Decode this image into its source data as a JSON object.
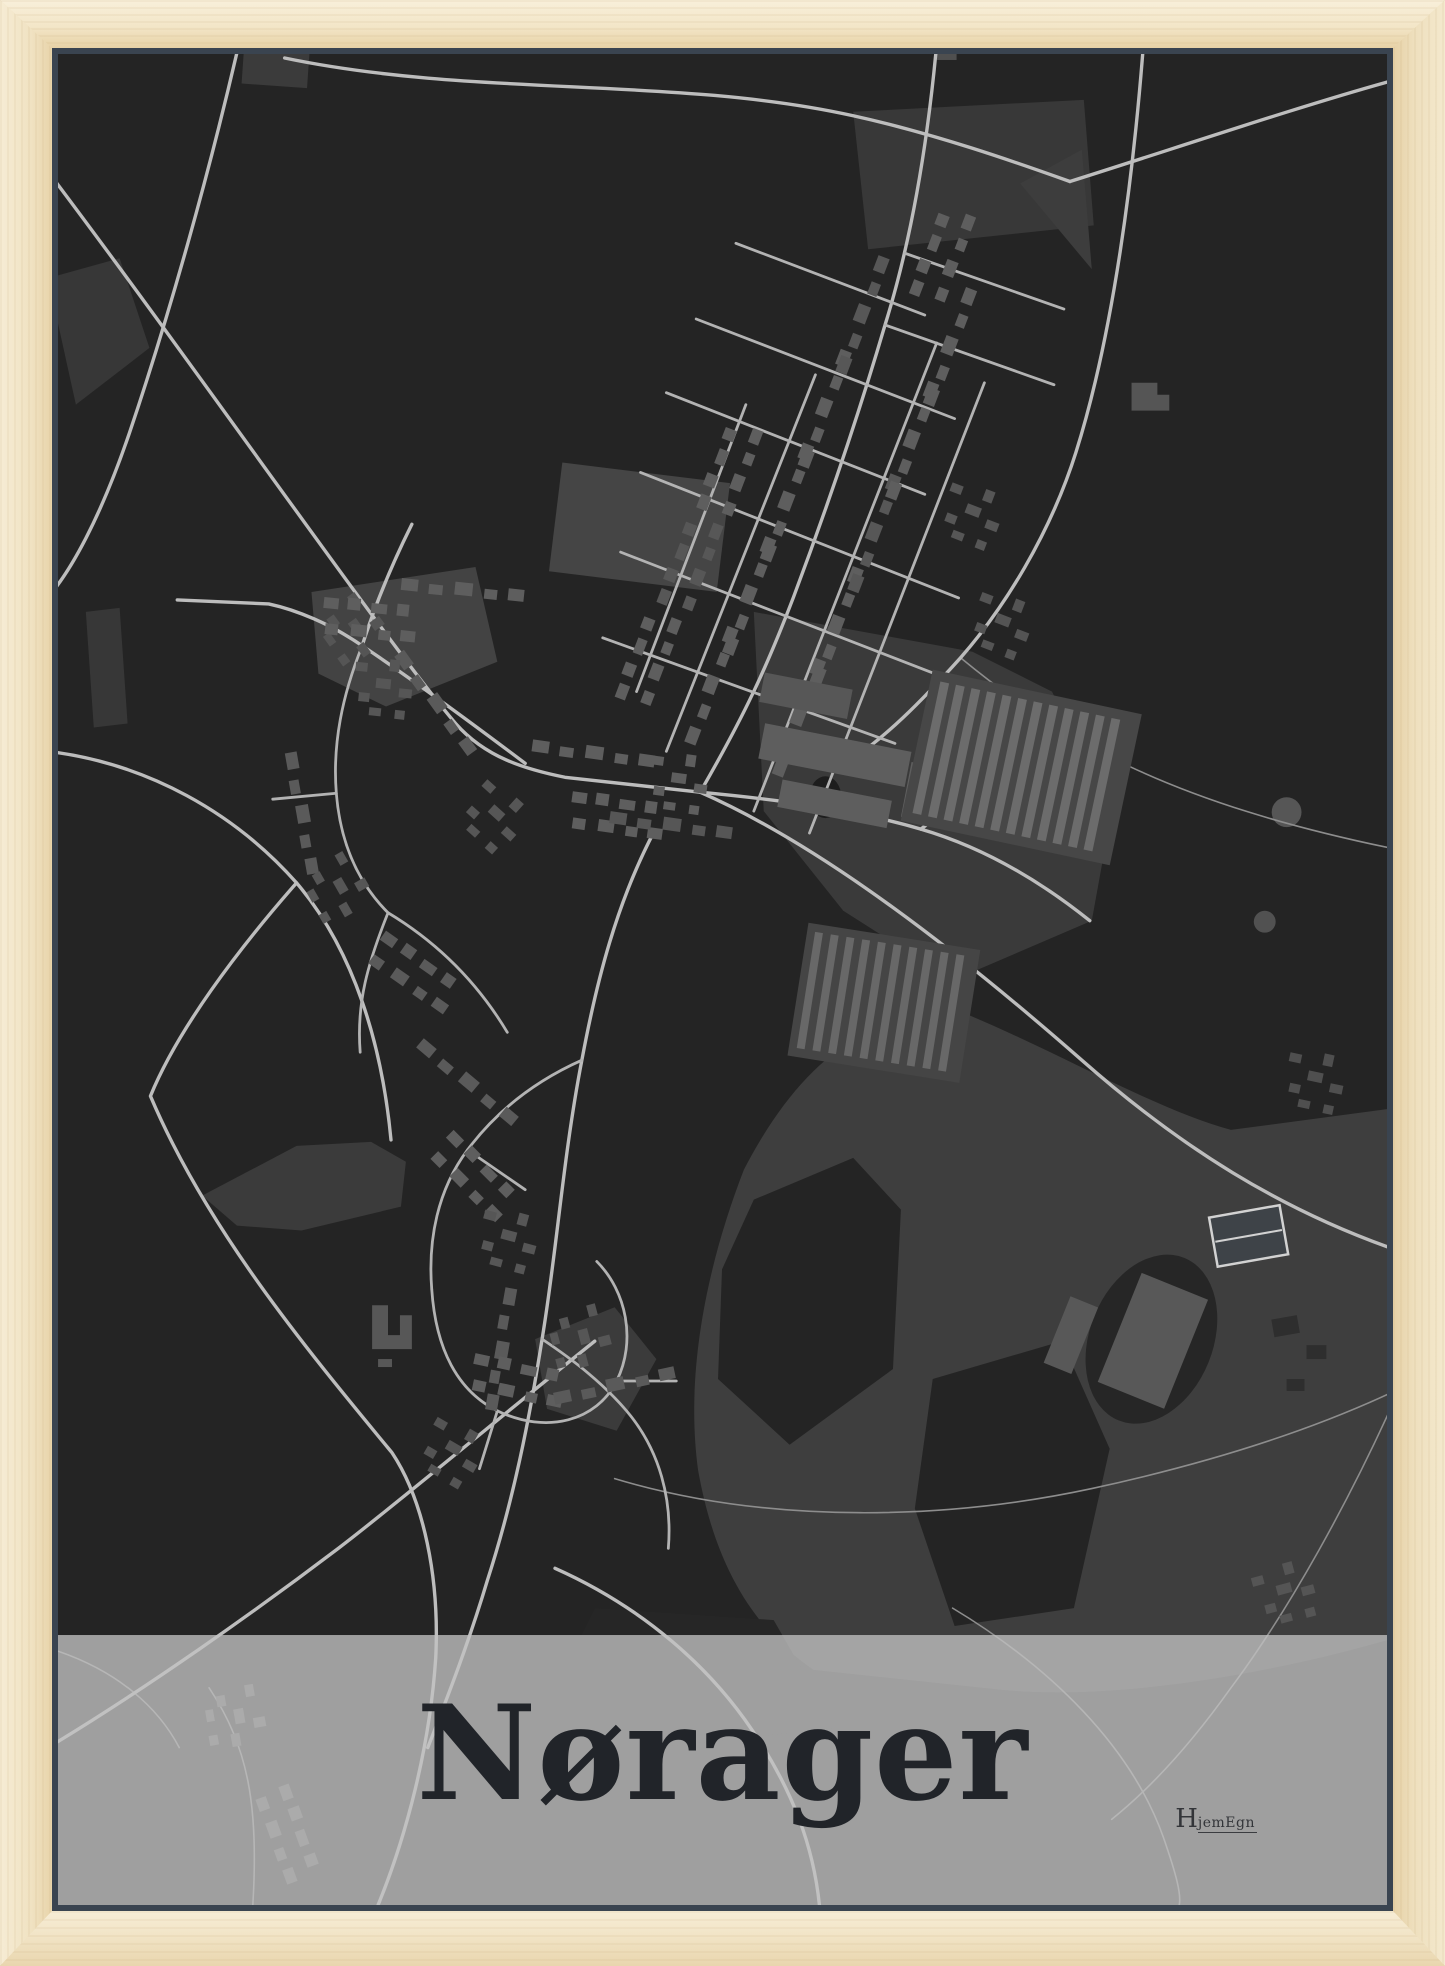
{
  "poster": {
    "title": "Nørager",
    "brand_prefix": "H",
    "brand_rest": "jemEgn"
  },
  "colors": {
    "frame_wood": "#f1e3c4",
    "frame_inner_border": "#3a4450",
    "map_background": "#242424",
    "major_road": "#bdbdbd",
    "minor_road": "#8d8d8d",
    "building": "#5e5e5e",
    "field_area": "#3e3e3e",
    "title_band": "#c2c2c2",
    "title_text": "#212429"
  }
}
